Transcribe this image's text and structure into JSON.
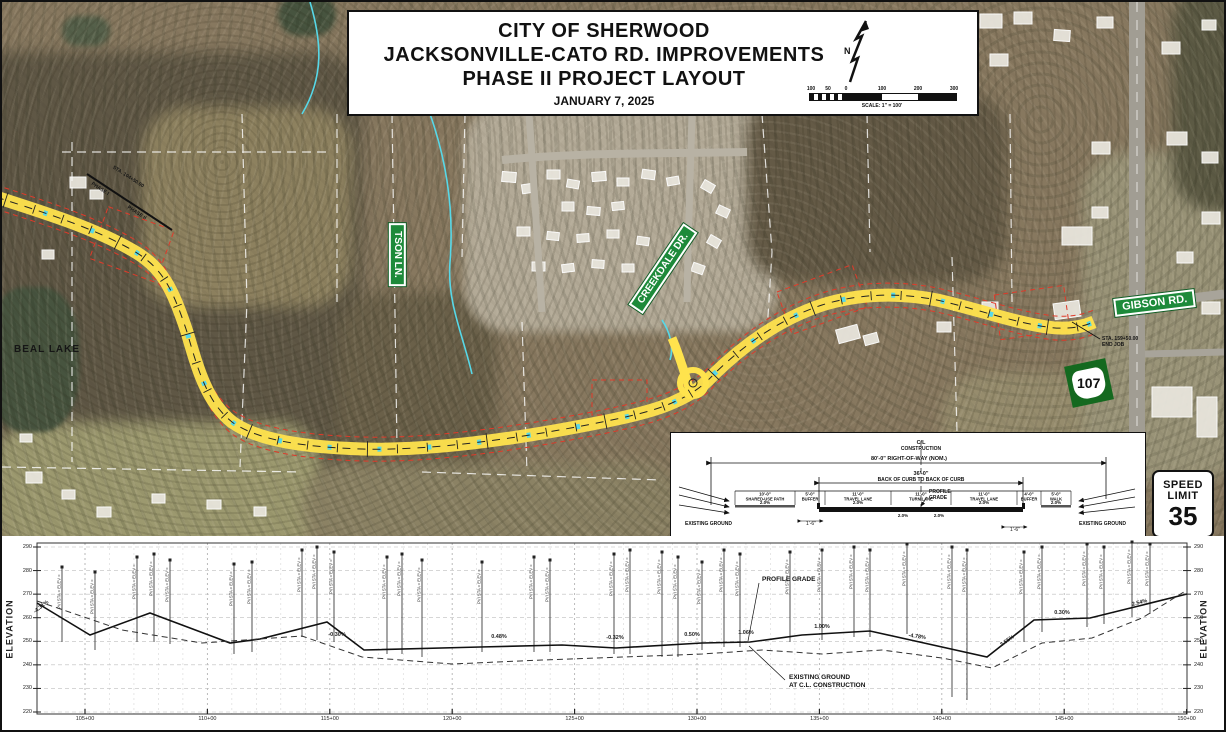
{
  "title_block": {
    "line1": "CITY OF SHERWOOD",
    "line2": "JACKSONVILLE-CATO RD. IMPROVEMENTS",
    "line3": "PHASE II PROJECT LAYOUT",
    "date": "JANUARY 7, 2025",
    "north_label": "N",
    "scale_ticks": [
      "100",
      "50",
      "0",
      "100",
      "200",
      "300"
    ],
    "scale_label": "SCALE: 1\" = 100'"
  },
  "map": {
    "lake_label": "BEAL LAKE",
    "signs": {
      "tson": "TSON LN.",
      "creekdale": "CREEKDALE DR.",
      "gibson": "GIBSON RD."
    },
    "route_shield": "107",
    "end_job_line1": "STA. 159+50.00",
    "end_job_line2": "END JOB",
    "phase1_label": "PHASE I",
    "phase_sta_label": "STA. 104+50.00",
    "phase2_label": "PHASE II",
    "colors": {
      "sign_green": "#1d8a3a",
      "corridor_yellow": "#ffe34d",
      "stream_cyan": "#57d8e8",
      "row_red": "#e03a2a"
    }
  },
  "speed_sign": {
    "line1": "SPEED",
    "line2": "LIMIT",
    "value": "35"
  },
  "typical_section": {
    "cl_line1": "C/L",
    "cl_line2": "CONSTRUCTION",
    "row_label": "80'-0\" RIGHT-OF-WAY (NOM.)",
    "bb_dim": "36'-0\"",
    "bb_label": "BACK OF CURB TO BACK OF CURB",
    "segments": [
      {
        "dim": "10'-0\"",
        "name": "SHARED-USE PATH"
      },
      {
        "dim": "5'-0\"",
        "name": "BUFFER"
      },
      {
        "dim": "11'-0\"",
        "name": "TRAVEL LANE"
      },
      {
        "dim": "11'-0\"",
        "name": "TURN LANE"
      },
      {
        "dim": "11'-0\"",
        "name": "TRAVEL LANE"
      },
      {
        "dim": "4'-0\"",
        "name": "BUFFER"
      },
      {
        "dim": "5'-0\"",
        "name": "WALK"
      }
    ],
    "slope_labels": [
      "2.0%",
      "2.0%",
      "2.0%",
      "2.0%",
      "2.0%",
      "2.0%"
    ],
    "profile_grade_line1": "PROFILE",
    "profile_grade_line2": "GRADE",
    "existing_ground_left": "EXISTING GROUND",
    "existing_ground_right": "EXISTING GROUND",
    "curb_dim_left": "1'-6\"",
    "curb_dim_right": "1'-6\""
  },
  "profile": {
    "axis_label_left": "ELEVATION",
    "axis_label_right": "ELEVATION",
    "y_ticks": [
      "290",
      "280",
      "270",
      "260",
      "250",
      "240",
      "230",
      "220"
    ],
    "x_ticks": [
      "105+00",
      "110+00",
      "115+00",
      "120+00",
      "125+00",
      "130+00",
      "135+00",
      "140+00",
      "145+00",
      "150+00"
    ],
    "profile_grade_label": "PROFILE GRADE",
    "existing_ground_line1": "EXISTING GROUND",
    "existing_ground_line2": "AT C.L. CONSTRUCTION",
    "cluster_label": "PVI STA = ELEV =",
    "grade_labels": [
      {
        "text": "-4.31%",
        "x": 40,
        "y": 606,
        "rot": -38
      },
      {
        "text": "-0.30%",
        "x": 335,
        "y": 634,
        "rot": 0
      },
      {
        "text": "0.48%",
        "x": 497,
        "y": 636,
        "rot": 0
      },
      {
        "text": "-0.32%",
        "x": 613,
        "y": 637,
        "rot": 0
      },
      {
        "text": "0.50%",
        "x": 690,
        "y": 634,
        "rot": 0
      },
      {
        "text": "1.06%",
        "x": 744,
        "y": 632,
        "rot": 0
      },
      {
        "text": "1.00%",
        "x": 820,
        "y": 626,
        "rot": 0
      },
      {
        "text": "-4.78%",
        "x": 915,
        "y": 636,
        "rot": 8
      },
      {
        "text": "3.55%",
        "x": 1006,
        "y": 640,
        "rot": -35
      },
      {
        "text": "0.30%",
        "x": 1060,
        "y": 612,
        "rot": 0
      },
      {
        "text": "2.54%",
        "x": 1138,
        "y": 602,
        "rot": -14
      }
    ],
    "design_line_px": [
      [
        35,
        601
      ],
      [
        88,
        633
      ],
      [
        148,
        611
      ],
      [
        228,
        641
      ],
      [
        258,
        637
      ],
      [
        325,
        620
      ],
      [
        362,
        648
      ],
      [
        478,
        645
      ],
      [
        560,
        643
      ],
      [
        614,
        646
      ],
      [
        700,
        641
      ],
      [
        748,
        640
      ],
      [
        800,
        633
      ],
      [
        868,
        629
      ],
      [
        985,
        655
      ],
      [
        1032,
        618
      ],
      [
        1088,
        616
      ],
      [
        1185,
        592
      ]
    ],
    "ground_line_px": [
      [
        35,
        599
      ],
      [
        120,
        628
      ],
      [
        200,
        641
      ],
      [
        300,
        634
      ],
      [
        360,
        655
      ],
      [
        450,
        662
      ],
      [
        540,
        658
      ],
      [
        620,
        655
      ],
      [
        700,
        652
      ],
      [
        760,
        648
      ],
      [
        820,
        652
      ],
      [
        880,
        648
      ],
      [
        940,
        656
      ],
      [
        990,
        666
      ],
      [
        1040,
        641
      ],
      [
        1090,
        636
      ],
      [
        1140,
        616
      ],
      [
        1185,
        588
      ]
    ],
    "clusters": [
      [
        60,
        565,
        640
      ],
      [
        93,
        570,
        648
      ],
      [
        135,
        555,
        640
      ],
      [
        152,
        552,
        640
      ],
      [
        168,
        558,
        642
      ],
      [
        232,
        562,
        652
      ],
      [
        250,
        560,
        650
      ],
      [
        300,
        548,
        635
      ],
      [
        315,
        545,
        638
      ],
      [
        332,
        550,
        640
      ],
      [
        385,
        555,
        652
      ],
      [
        400,
        552,
        652
      ],
      [
        420,
        558,
        655
      ],
      [
        480,
        560,
        650
      ],
      [
        532,
        555,
        650
      ],
      [
        548,
        558,
        650
      ],
      [
        612,
        552,
        652
      ],
      [
        628,
        548,
        652
      ],
      [
        660,
        550,
        655
      ],
      [
        676,
        555,
        655
      ],
      [
        700,
        560,
        648
      ],
      [
        722,
        548,
        645
      ],
      [
        738,
        552,
        645
      ],
      [
        788,
        550,
        640
      ],
      [
        820,
        548,
        638
      ],
      [
        852,
        545,
        635
      ],
      [
        868,
        548,
        635
      ],
      [
        905,
        542,
        632
      ],
      [
        950,
        545,
        695
      ],
      [
        965,
        548,
        698
      ],
      [
        1022,
        550,
        640
      ],
      [
        1040,
        545,
        630
      ],
      [
        1085,
        542,
        625
      ],
      [
        1102,
        545,
        622
      ],
      [
        1130,
        540,
        615
      ],
      [
        1148,
        542,
        612
      ]
    ]
  }
}
